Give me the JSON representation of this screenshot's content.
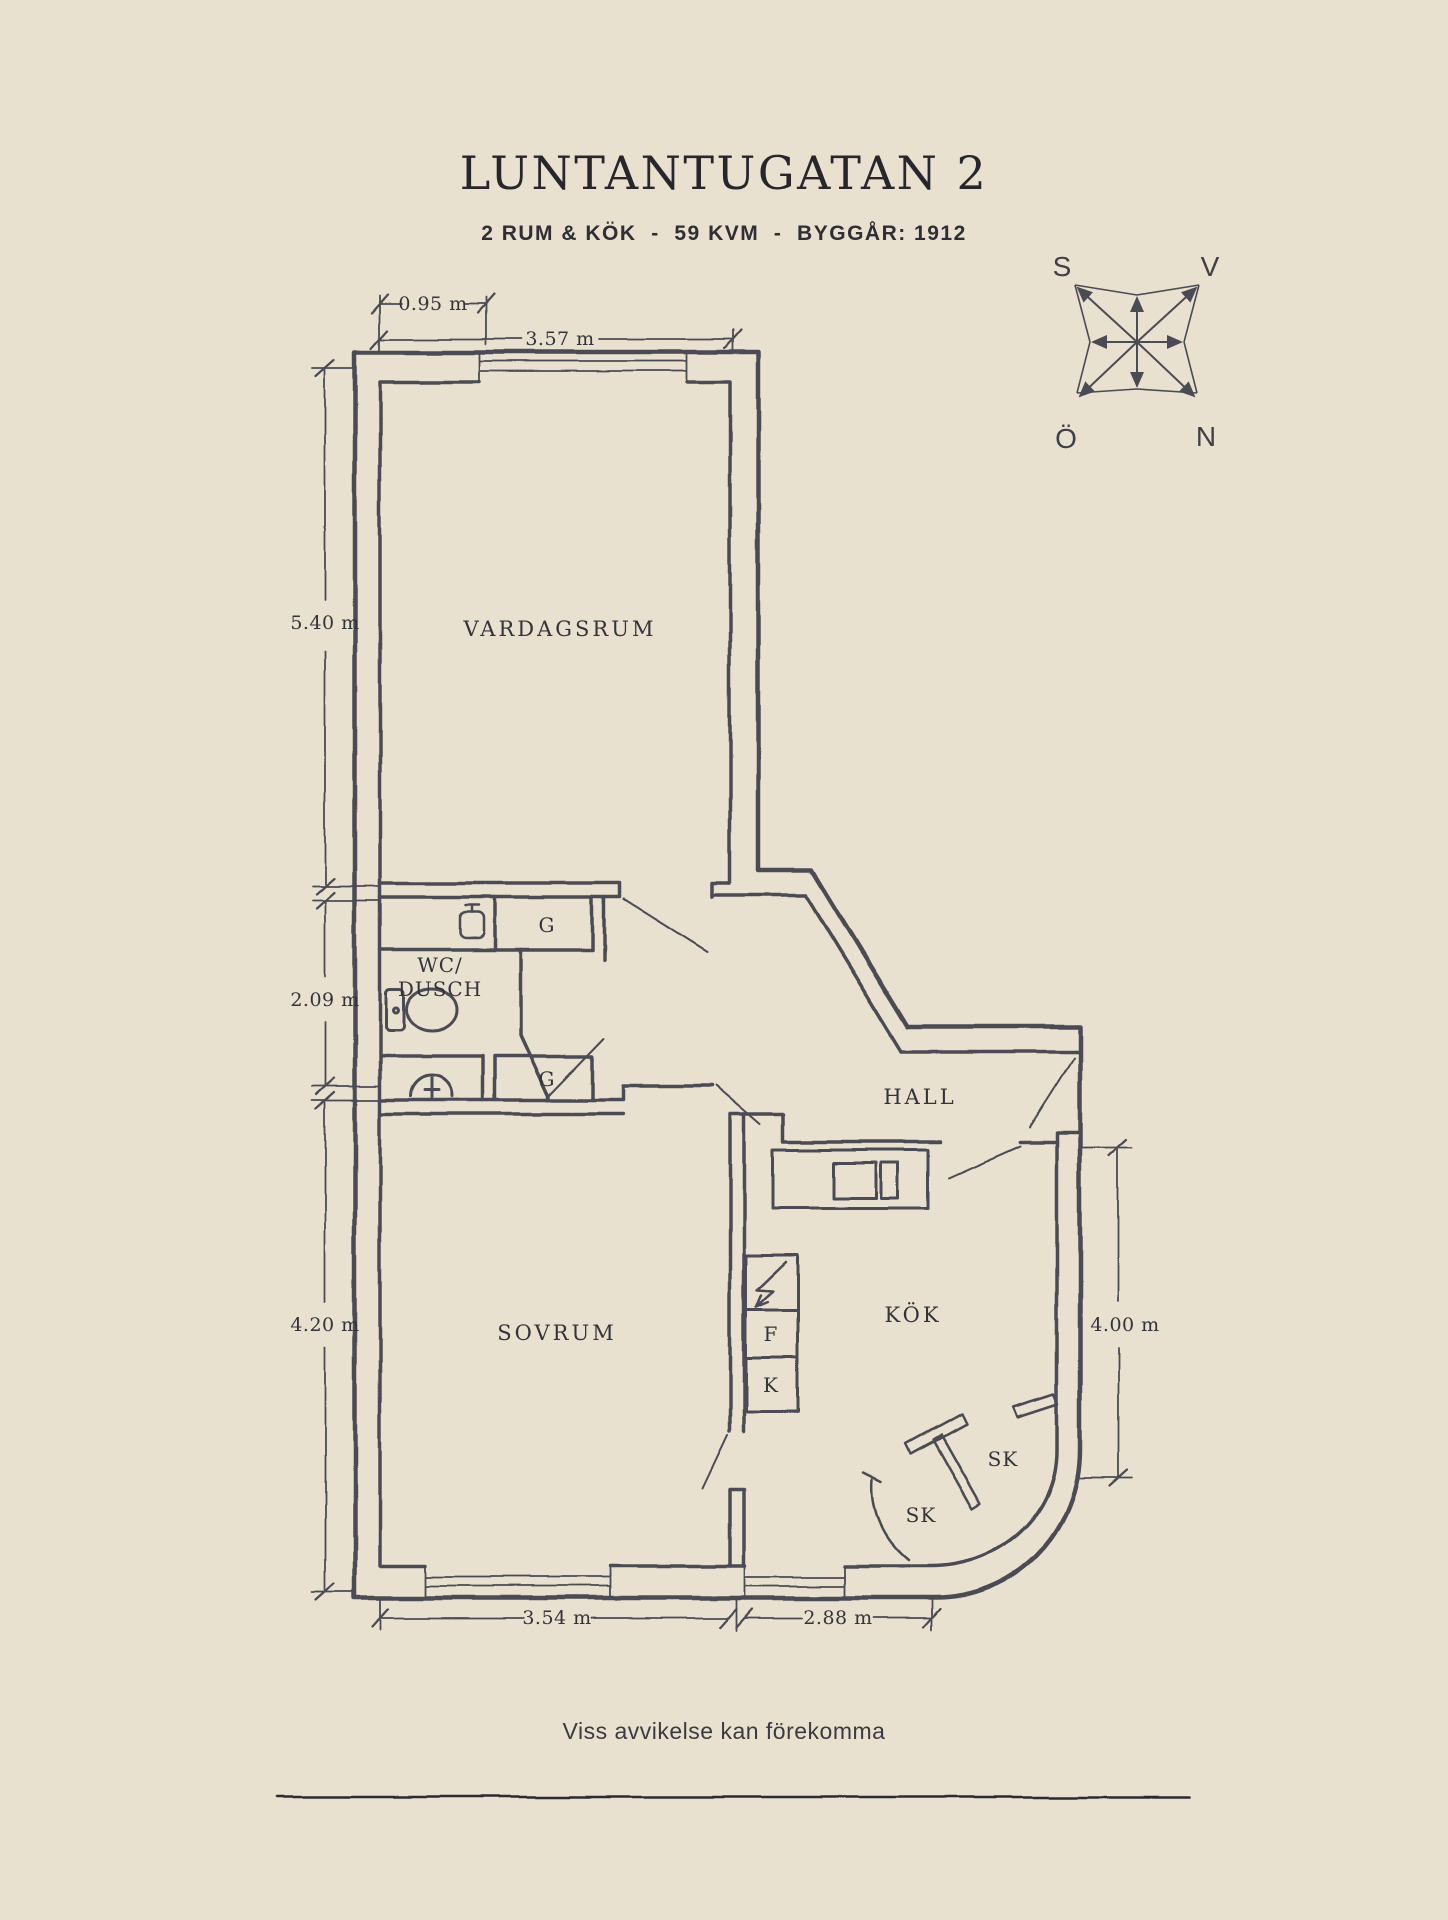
{
  "page": {
    "title": "LUNTANTUGATAN 2",
    "subtitle": "2 RUM & KÖK  -  59 KVM  -  BYGGÅR: 1912",
    "disclaimer": "Viss avvikelse kan förekomma",
    "colors": {
      "background": "#e8e1cf",
      "ink": "#4b4b54",
      "text": "#33333a"
    }
  },
  "compass": {
    "nw": "S",
    "ne": "V",
    "sw": "Ö",
    "se": "N"
  },
  "rooms": {
    "living_room": "VARDAGSRUM",
    "bedroom": "SOVRUM",
    "kitchen": "KÖK",
    "hall": "HALL",
    "bathroom_line1": "WC/",
    "bathroom_line2": "DUSCH"
  },
  "fixtures": {
    "wardrobe_upper": "G",
    "wardrobe_lower": "G",
    "fridge_label": "F",
    "freezer_label": "K",
    "cabinet_right": "SK",
    "cabinet_left": "SK"
  },
  "dimensions": {
    "top_window": "0.95 m",
    "top_width": "3.57 m",
    "left_living": "5.40 m",
    "left_bath": "2.09 m",
    "left_bedroom": "4.20 m",
    "right_kitchen": "4.00 m",
    "bottom_bedroom": "3.54 m",
    "bottom_kitchen": "2.88 m"
  }
}
